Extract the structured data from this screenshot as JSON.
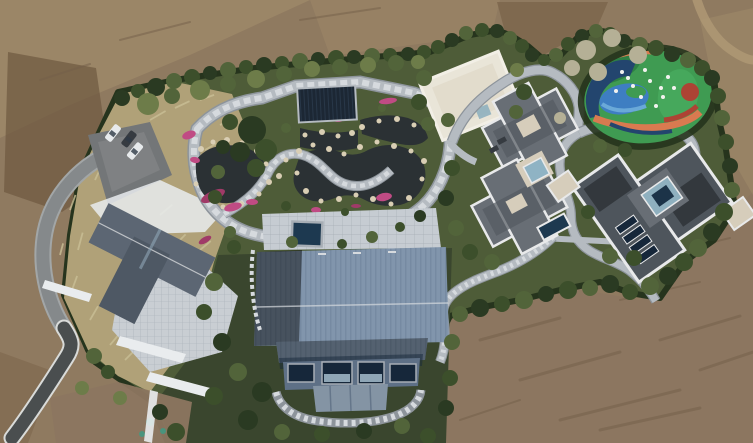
{
  "scene": {
    "type": "aerial-drone-photograph",
    "description": "Top-down aerial view of a landscaped private estate: a central barn-style building with a ribbed blue metal roof, a rock-edged water garden with winding stone paths and pink flower beds, a dark navy pavilion, several gray hip-roofed villas, a modern flat-roofed house, a white flat-roofed court building, a colorful children's playground, a parking pad with three cars, a looping driveway, all enclosed by a dense evergreen hedge and surrounded by bare brown earth."
  },
  "colors": {
    "dirtbase": "#8f7a60",
    "dirtdark": "#6e5840",
    "dirtlight": "#a6906e",
    "dirtmid": "#7d664c",
    "dirtbottom": "#8c7660",
    "dirtstreak": "#74604a",
    "dirttrack": "#b09a76",
    "hedge": "#26341d",
    "t0": "#2a3a22",
    "t1": "#3c4f2b",
    "t2": "#52643a",
    "t3": "#6d7c49",
    "t4": "#b5b096",
    "lawn": "#4e5c38",
    "lawndark": "#3a462e",
    "drygrass": "#b0a178",
    "drygrasslight": "#cabf96",
    "pathstone": "#b5bbc1",
    "pathdash": "#d6dade",
    "pathedge": "#8d949b",
    "terrace": "#c6ccd2",
    "terraceline": "#a7aeb5",
    "asphalt": "#4a4e4f",
    "curb": "#d9dbd9",
    "driveway": "#85898b",
    "driveedge": "#a2a6a7",
    "parking": "#737678",
    "parkinglight": "#87898b",
    "pond": "#2b3134",
    "rock": "#d9ceb4",
    "flower": "#c04b84",
    "flowerdeep": "#a03a68",
    "roofslate": "#5c6673",
    "roofslatedark": "#4e5864",
    "patio": "#c9ced3",
    "whitewall": "#e9ecee",
    "roofblue": "#8195ac",
    "roofbluerib": "#73879e",
    "roofbluedark": "#6d8098",
    "wallblue": "#5e7086",
    "windownavy": "#16273a",
    "windowsky": "#8fa6b6",
    "walllower": "#8494a4",
    "mullion": "#65768a",
    "pavilion": "#1c2734",
    "pavilionrib": "#2b3b4d",
    "bldgwhite": "#e9e5d8",
    "bldgwhiteedge": "#f2efe6",
    "bldgwhiteshade": "#ddd5c3",
    "roofgray": "#686e75",
    "roofgraydark": "#545a61",
    "parapet": "#e8e9ea",
    "cream": "#d6cdbb",
    "courtglass": "#8fb3c4",
    "poolnavy": "#1d3950",
    "housedark": "#33383d",
    "housemid": "#4e555c",
    "skylight": "#8fb0bf",
    "skylightdeep": "#1c3348",
    "playgreen": "#3f9b52",
    "playgreendark": "#2e8044",
    "playgreenbright": "#46a85c",
    "playblue": "#3e7ec2",
    "playbluelight": "#6aa9d8",
    "playorange": "#d97a50",
    "playred": "#ad4334",
    "playnavy": "#23456e",
    "playwhite": "#f2f2ef",
    "carwhite": "#e7eaec",
    "cardark": "#363b41",
    "carglass": "#2e3a46",
    "teal": "#3f9a82",
    "shadow": "#2c3026"
  },
  "counts": {
    "cars": 3,
    "main_buildings": 5,
    "pavilions": 1,
    "playgrounds": 1,
    "ponds": 3
  },
  "trees": [
    [
      122,
      98,
      8,
      0
    ],
    [
      138,
      91,
      7,
      1
    ],
    [
      156,
      87,
      9,
      0
    ],
    [
      174,
      81,
      8,
      2
    ],
    [
      192,
      77,
      8,
      1
    ],
    [
      210,
      73,
      7,
      0
    ],
    [
      228,
      70,
      8,
      2
    ],
    [
      246,
      67,
      7,
      1
    ],
    [
      264,
      65,
      8,
      0
    ],
    [
      282,
      63,
      7,
      1
    ],
    [
      300,
      61,
      8,
      2
    ],
    [
      318,
      59,
      7,
      0
    ],
    [
      336,
      58,
      8,
      1
    ],
    [
      354,
      57,
      7,
      0
    ],
    [
      372,
      56,
      8,
      2
    ],
    [
      390,
      55,
      7,
      1
    ],
    [
      408,
      54,
      7,
      0
    ],
    [
      424,
      52,
      7,
      1
    ],
    [
      148,
      104,
      11,
      3
    ],
    [
      172,
      96,
      8,
      2
    ],
    [
      200,
      90,
      10,
      3
    ],
    [
      228,
      84,
      8,
      2
    ],
    [
      256,
      79,
      9,
      3
    ],
    [
      284,
      74,
      8,
      2
    ],
    [
      312,
      69,
      8,
      3
    ],
    [
      340,
      67,
      8,
      2
    ],
    [
      368,
      65,
      8,
      3
    ],
    [
      396,
      63,
      8,
      2
    ],
    [
      418,
      62,
      7,
      3
    ],
    [
      438,
      47,
      7,
      1
    ],
    [
      452,
      40,
      7,
      0
    ],
    [
      466,
      33,
      7,
      2
    ],
    [
      482,
      30,
      7,
      1
    ],
    [
      497,
      31,
      7,
      0
    ],
    [
      510,
      38,
      7,
      2
    ],
    [
      522,
      46,
      7,
      1
    ],
    [
      532,
      55,
      7,
      0
    ],
    [
      544,
      60,
      6,
      1
    ],
    [
      556,
      55,
      7,
      2
    ],
    [
      568,
      44,
      7,
      1
    ],
    [
      582,
      36,
      7,
      0
    ],
    [
      596,
      31,
      7,
      2
    ],
    [
      610,
      34,
      7,
      1
    ],
    [
      624,
      41,
      7,
      0
    ],
    [
      640,
      45,
      8,
      2
    ],
    [
      656,
      48,
      8,
      1
    ],
    [
      672,
      54,
      8,
      0
    ],
    [
      688,
      60,
      8,
      2
    ],
    [
      702,
      68,
      8,
      1
    ],
    [
      712,
      78,
      8,
      0
    ],
    [
      586,
      50,
      10,
      4
    ],
    [
      612,
      38,
      9,
      4
    ],
    [
      638,
      55,
      9,
      4
    ],
    [
      572,
      68,
      8,
      4
    ],
    [
      598,
      72,
      9,
      4
    ],
    [
      560,
      118,
      6,
      4
    ],
    [
      424,
      78,
      8,
      2
    ],
    [
      419,
      102,
      8,
      1
    ],
    [
      428,
      124,
      7,
      2
    ],
    [
      517,
      70,
      7,
      3
    ],
    [
      524,
      92,
      8,
      1
    ],
    [
      516,
      112,
      7,
      2
    ],
    [
      718,
      96,
      8,
      1
    ],
    [
      722,
      118,
      8,
      2
    ],
    [
      726,
      142,
      8,
      1
    ],
    [
      730,
      166,
      8,
      0
    ],
    [
      732,
      190,
      8,
      2
    ],
    [
      724,
      212,
      9,
      1
    ],
    [
      712,
      232,
      9,
      0
    ],
    [
      698,
      248,
      9,
      2
    ],
    [
      684,
      262,
      9,
      1
    ],
    [
      668,
      276,
      9,
      0
    ],
    [
      650,
      286,
      9,
      2
    ],
    [
      630,
      292,
      8,
      1
    ],
    [
      610,
      284,
      9,
      0
    ],
    [
      590,
      288,
      8,
      2
    ],
    [
      568,
      290,
      9,
      1
    ],
    [
      546,
      294,
      8,
      0
    ],
    [
      524,
      300,
      9,
      2
    ],
    [
      502,
      304,
      8,
      1
    ],
    [
      480,
      308,
      9,
      0
    ],
    [
      460,
      314,
      8,
      2
    ],
    [
      448,
      120,
      7,
      2
    ],
    [
      452,
      168,
      8,
      1
    ],
    [
      446,
      198,
      8,
      0
    ],
    [
      456,
      228,
      8,
      2
    ],
    [
      470,
      252,
      8,
      1
    ],
    [
      492,
      262,
      8,
      2
    ],
    [
      588,
      212,
      7,
      1
    ],
    [
      610,
      256,
      8,
      2
    ],
    [
      634,
      258,
      8,
      1
    ],
    [
      600,
      146,
      7,
      2
    ],
    [
      625,
      150,
      7,
      1
    ],
    [
      214,
      282,
      9,
      2
    ],
    [
      204,
      312,
      8,
      1
    ],
    [
      222,
      342,
      9,
      0
    ],
    [
      238,
      372,
      9,
      2
    ],
    [
      214,
      396,
      9,
      1
    ],
    [
      248,
      420,
      10,
      0
    ],
    [
      282,
      432,
      8,
      2
    ],
    [
      322,
      434,
      8,
      1
    ],
    [
      364,
      431,
      8,
      0
    ],
    [
      402,
      426,
      8,
      2
    ],
    [
      428,
      436,
      8,
      1
    ],
    [
      452,
      342,
      8,
      2
    ],
    [
      450,
      378,
      8,
      1
    ],
    [
      446,
      408,
      8,
      0
    ],
    [
      234,
      247,
      7,
      1
    ],
    [
      262,
      392,
      10,
      0
    ],
    [
      230,
      122,
      8,
      1
    ],
    [
      223,
      147,
      7,
      0
    ],
    [
      218,
      172,
      7,
      2
    ],
    [
      215,
      197,
      7,
      1
    ],
    [
      252,
      130,
      14,
      0
    ],
    [
      266,
      150,
      11,
      1
    ],
    [
      240,
      152,
      10,
      0
    ],
    [
      256,
      168,
      9,
      1
    ],
    [
      286,
      206,
      5,
      1
    ],
    [
      345,
      212,
      4,
      1
    ],
    [
      286,
      128,
      5,
      2
    ],
    [
      382,
      108,
      4,
      2
    ],
    [
      292,
      242,
      6,
      2
    ],
    [
      342,
      244,
      5,
      1
    ],
    [
      372,
      237,
      6,
      2
    ],
    [
      400,
      227,
      5,
      1
    ],
    [
      420,
      216,
      6,
      0
    ],
    [
      230,
      232,
      6,
      2
    ],
    [
      176,
      432,
      9,
      1
    ],
    [
      160,
      412,
      8,
      0
    ],
    [
      94,
      356,
      8,
      2
    ],
    [
      108,
      372,
      7,
      1
    ],
    [
      82,
      388,
      7,
      3
    ],
    [
      120,
      398,
      7,
      3
    ]
  ],
  "rocks": [
    [
      201,
      149,
      3
    ],
    [
      213,
      142,
      2.5
    ],
    [
      227,
      140,
      3
    ],
    [
      242,
      143,
      2.5
    ],
    [
      257,
      151,
      3
    ],
    [
      266,
      164,
      2.5
    ],
    [
      269,
      182,
      3
    ],
    [
      259,
      194,
      2.5
    ],
    [
      241,
      204,
      3
    ],
    [
      223,
      207,
      2.5
    ],
    [
      206,
      200,
      3
    ],
    [
      196,
      184,
      2.5
    ],
    [
      299,
      151,
      3
    ],
    [
      313,
      145,
      2.5
    ],
    [
      329,
      149,
      3
    ],
    [
      344,
      154,
      2.5
    ],
    [
      360,
      147,
      3
    ],
    [
      377,
      142,
      2.5
    ],
    [
      394,
      146,
      3
    ],
    [
      411,
      151,
      2.5
    ],
    [
      424,
      161,
      3
    ],
    [
      422,
      179,
      2.5
    ],
    [
      409,
      198,
      3
    ],
    [
      391,
      204,
      2.5
    ],
    [
      373,
      199,
      3
    ],
    [
      356,
      195,
      2.5
    ],
    [
      339,
      199,
      3
    ],
    [
      321,
      201,
      2.5
    ],
    [
      306,
      191,
      3
    ],
    [
      297,
      173,
      2.5
    ],
    [
      362,
      127,
      3
    ],
    [
      379,
      121,
      2.5
    ],
    [
      397,
      119,
      3
    ],
    [
      414,
      125,
      2.5
    ],
    [
      305,
      135,
      2.5
    ],
    [
      322,
      132,
      3
    ],
    [
      338,
      136,
      2.5
    ],
    [
      352,
      133,
      3
    ],
    [
      286,
      160,
      2.5
    ],
    [
      279,
      176,
      3
    ]
  ],
  "flowers": [
    [
      189,
      135,
      7,
      4,
      -20
    ],
    [
      195,
      160,
      5,
      3,
      10
    ],
    [
      213,
      196,
      13,
      5,
      -25
    ],
    [
      233,
      207,
      9,
      4,
      -15
    ],
    [
      252,
      202,
      6,
      3,
      0
    ],
    [
      300,
      233,
      7,
      3,
      5
    ],
    [
      384,
      197,
      8,
      4,
      -10
    ],
    [
      388,
      101,
      9,
      3,
      -8
    ],
    [
      205,
      240,
      7,
      3,
      -30
    ],
    [
      338,
      120,
      5,
      2,
      0
    ],
    [
      316,
      210,
      5,
      3,
      0
    ],
    [
      356,
      206,
      5,
      2,
      0
    ]
  ],
  "cars": [
    [
      113,
      133,
      18,
      8,
      -52,
      "w"
    ],
    [
      129,
      139,
      17,
      8,
      -52,
      "d"
    ],
    [
      135,
      151,
      18,
      8,
      -50,
      "w"
    ]
  ],
  "play_dots": [
    [
      628,
      78
    ],
    [
      645,
      70
    ],
    [
      661,
      88
    ],
    [
      641,
      97
    ],
    [
      616,
      91
    ],
    [
      656,
      106
    ],
    [
      668,
      77
    ],
    [
      633,
      86
    ],
    [
      650,
      81
    ],
    [
      663,
      97
    ],
    [
      622,
      72
    ],
    [
      674,
      88
    ]
  ],
  "grass_streaks": [
    [
      70,
      210,
      16,
      -70
    ],
    [
      78,
      250,
      18,
      -75
    ],
    [
      72,
      290,
      15,
      -70
    ],
    [
      90,
      320,
      16,
      -60
    ],
    [
      110,
      345,
      14,
      -50
    ],
    [
      150,
      120,
      18,
      -30
    ],
    [
      175,
      108,
      16,
      -25
    ],
    [
      200,
      100,
      15,
      -20
    ],
    [
      130,
      135,
      14,
      -35
    ],
    [
      160,
      215,
      16,
      -40
    ],
    [
      175,
      245,
      15,
      -45
    ],
    [
      188,
      275,
      14,
      -50
    ],
    [
      165,
      300,
      16,
      -45
    ],
    [
      145,
      330,
      15,
      -40
    ],
    [
      185,
      320,
      13,
      -45
    ],
    [
      200,
      250,
      14,
      -40
    ],
    [
      95,
      180,
      15,
      -65
    ],
    [
      105,
      150,
      14,
      -55
    ],
    [
      205,
      150,
      13,
      -30
    ],
    [
      220,
      125,
      14,
      -25
    ],
    [
      125,
      360,
      14,
      -45
    ],
    [
      168,
      355,
      13,
      -40
    ],
    [
      60,
      255,
      12,
      -75
    ],
    [
      210,
      215,
      13,
      -35
    ]
  ],
  "dirt_streaks": [
    [
      480,
      340,
      560,
      318,
      3
    ],
    [
      520,
      380,
      620,
      352,
      3
    ],
    [
      560,
      420,
      680,
      390,
      3
    ],
    [
      620,
      300,
      700,
      282,
      2
    ],
    [
      660,
      340,
      740,
      316,
      3
    ],
    [
      600,
      430,
      700,
      408,
      3
    ],
    [
      700,
      370,
      753,
      352,
      3
    ],
    [
      40,
      80,
      90,
      64,
      2
    ],
    [
      120,
      40,
      190,
      22,
      2
    ],
    [
      300,
      20,
      380,
      8,
      2
    ],
    [
      680,
      250,
      730,
      238,
      2
    ],
    [
      460,
      420,
      520,
      400,
      2
    ]
  ],
  "teal_marks": [
    [
      150,
      422,
      4
    ],
    [
      163,
      431,
      3
    ],
    [
      142,
      434,
      3
    ]
  ]
}
